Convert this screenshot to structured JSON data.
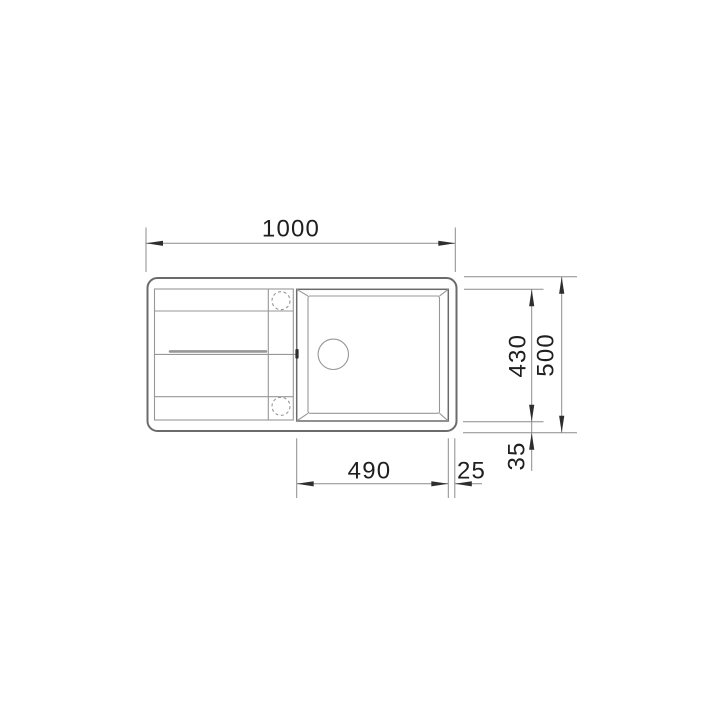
{
  "drawing": {
    "dim_overall_width": "1000",
    "dim_overall_depth": "500",
    "dim_bowl_depth": "430",
    "dim_bowl_width": "490",
    "dim_gap_right": "25",
    "dim_gap_bottom": "35"
  },
  "colors": {
    "background": "#ffffff",
    "outline": "#6b6b6b",
    "inner_line": "#979797",
    "dimension_line": "#8c8c8c",
    "dimension_text": "#1f1f1f",
    "arrow": "#2e2e2e"
  }
}
